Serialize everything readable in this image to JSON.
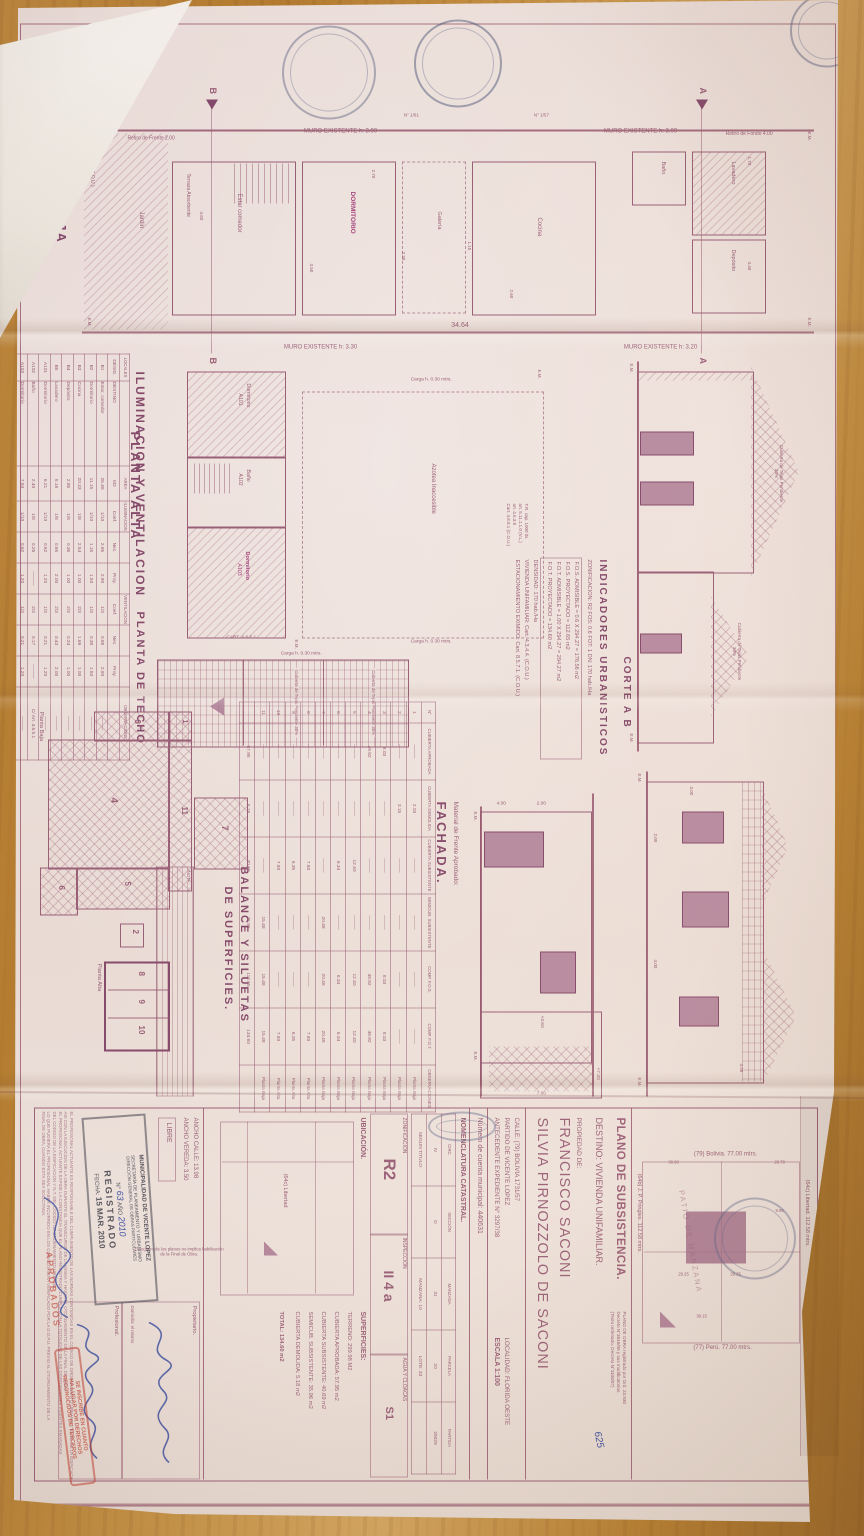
{
  "photo": {
    "background": "wood-table"
  },
  "colors": {
    "ink": "#9a5e77",
    "pink_fill": "#b286a2",
    "highlight": "#a8437e",
    "red_stamp": "#c23b2e",
    "blue_ink": "#3f51a3",
    "paper": "#f0e3de"
  },
  "misc": {
    "em": "E.M."
  },
  "planta_baja": {
    "title": "PLANTA BAJA",
    "calle": "Calle: (79) Bolivia",
    "cart": "CART. 4.7.3.2.2 (C.O.U.)",
    "muro1": "MURO EXISTENTE h: 3.00",
    "muro2": "MURO EXISTENTE h: 3.20",
    "muro3": "MURO EXISTENTE h: 3.00",
    "muro4": "MURO EXISTENTE h: 3.30",
    "retiro_frente": "Retiro de Frente 2.00",
    "retiro_fondo": "Retiro de Fondo 4.00",
    "jardin": "Jardín",
    "terraza": "Terraza Absorbente",
    "galeria": "Galería",
    "rooms": {
      "estar": "Estar comedor",
      "dorm": "DORMITORIO",
      "cocina": "Cocina",
      "deposito": "Depósito",
      "lavadero": "Lavadero",
      "bano": "Baño"
    },
    "dim_total": "34.64",
    "dims": [
      "3.30",
      "3.50",
      "2.70",
      "4.60",
      "1.70",
      "2.60",
      "4.40",
      "1.15"
    ],
    "marker_b": "B",
    "marker_a": "A",
    "nums": [
      "N° 1/57",
      "N° 1/61"
    ]
  },
  "corte": {
    "title": "CORTE A B",
    "cubierta": "Cubierta de Tejas Pendiente 30%"
  },
  "indicadores": {
    "title": "INDICADORES URBANISTICOS",
    "lines": [
      "ZONIFICACION: R2   FOS: 0.6   FOT: 1   DN: 170 hab./Ha",
      "F.O.S. ADMISIBLE = 0.6 X 294.27 = 176.56 m2",
      "F.O.S. PROYECTADO = 112.65 m2",
      "F.O.T. ADMISIBLE = 1.00 X 294.27 = 294.27 m2",
      "F.O.T. PROYECTADO = 134.60 m2",
      "DENSIDAD: 170 hab./Ha",
      "VIVIENDA UNIFAMILIAR: Cart. 4.3.4.4. (C.O.U.)",
      "ESTACIONAMIENTO EXIMIDO: Cart. 8.5.7.1. (C.O.U.)"
    ]
  },
  "planta_alta": {
    "title": "PLANTA ALTA",
    "azotea": "Azotea Inaccesible",
    "carga": "Carga h. 0.30 mtrs.",
    "cart": "CART. 4.6.5.1",
    "tr_note": [
      "T.R. cap. 1000 lts.",
      "art. 5.11.1.1.0 (V.L.)",
      "art. 4.6.3.8",
      "Cart. 4.8.8.1 (C.O.U.)"
    ],
    "rooms": {
      "a101_name": "Dormitorio",
      "a101": "A101",
      "a102_name": "Baño",
      "a102": "A102",
      "a103_name": "Dormitorio",
      "a103": "A103"
    }
  },
  "planta_techo": {
    "title": "PLANTA DE TECHO",
    "cubierta": "Cubierta de Tejas Pendiente 30%",
    "carga": "Carga h. 0.30 mtrs."
  },
  "fachada": {
    "title": "FACHADA.",
    "material": "Material de Frente Aprobado:",
    "dims": [
      "7.60",
      "2.00",
      "4.00",
      "+7.30",
      "+3.60"
    ]
  },
  "elevacion": {
    "dims": [
      "3.98",
      "3.00",
      "2.00",
      "4.00"
    ]
  },
  "iluminacion": {
    "title": "ILUMINACION Y VENTILACION",
    "table": [
      [
        "LOCALES",
        "",
        "AREA",
        "ILUMINACION",
        "",
        "",
        "VENTILACION",
        "",
        "",
        "OBSERVACIONES"
      ],
      [
        "DESIG.",
        "DESTINO",
        "M2",
        "Coef.",
        "Nec.",
        "Proy.",
        "Coef.",
        "Nec.",
        "Proy.",
        ""
      ],
      [
        "B1",
        "Estar, comedor",
        "26.48",
        "1/10",
        "2.65",
        "2.90",
        "1/3",
        "0.88",
        "2.90",
        "———"
      ],
      [
        "B2",
        "Dormitorio",
        "11.15",
        "1/10",
        "1.15",
        "1.50",
        "1/3",
        "0.38",
        "1.50",
        "———"
      ],
      [
        "B3",
        "Cocina",
        "20.33",
        "1/8",
        "2.54",
        "1.00",
        "2/3",
        "1.69",
        "1.00",
        "———"
      ],
      [
        "B4",
        "Depósito",
        "2.85",
        "1/8",
        "0.36",
        "1.00",
        "2/3",
        "0.24",
        "1.00",
        "———"
      ],
      [
        "B5",
        "Lavadero",
        "5.18",
        "1/8",
        "0.65",
        "2.00",
        "2/3",
        "0.43",
        "2.00",
        "———"
      ],
      [
        "A101",
        "Dormitorio",
        "6.21",
        "1/10",
        "0.62",
        "1.20",
        "1/3",
        "0.21",
        "1.20",
        "———"
      ],
      [
        "A102",
        "Baño",
        "2.40",
        "1/8",
        "0.26",
        "———",
        "2/3",
        "0.17",
        "———",
        "C/ Art. 4.6.5.1"
      ],
      [
        "A103",
        "Dormitorio",
        "7.50",
        "1/10",
        "0.62",
        "1.20",
        "1/3",
        "0.21",
        "1.20",
        "———"
      ]
    ]
  },
  "balance": {
    "title_1": "BALANCE Y SILUETAS",
    "title_2": "DE SUPERFICIES.",
    "nota": "NOTA:",
    "planta_baja_label": "Planta Baja",
    "planta_alta_label": "Planta Alta",
    "silhouettes": [
      "1",
      "2",
      "3",
      "4",
      "5",
      "6",
      "7",
      "8",
      "9",
      "10",
      "11"
    ],
    "table": [
      [
        "N°",
        "CUBIERTA APROBADA",
        "CUBIERTA DEMOLIDA",
        "CUBIERTA SUBSISTENTE",
        "SEMICUB. SUBSISTENTE",
        "COMP. F.O.S.",
        "COMP. F.O.T.",
        "OBSERVACIONES"
      ],
      [
        "1",
        "———",
        "2.03",
        "———",
        "———",
        "———",
        "———",
        "Planta Baja"
      ],
      [
        "2",
        "———",
        "3.15",
        "———",
        "———",
        "———",
        "———",
        "Planta Baja"
      ],
      [
        "3",
        "8.03",
        "———",
        "———",
        "———",
        "8.03",
        "8.03",
        "Planta Baja"
      ],
      [
        "4",
        "49.92",
        "———",
        "———",
        "———",
        "49.92",
        "49.92",
        "Planta Baja"
      ],
      [
        "5",
        "———",
        "———",
        "12.40",
        "———",
        "12.40",
        "12.40",
        "Planta Baja"
      ],
      [
        "6",
        "———",
        "———",
        "6.34",
        "———",
        "6.34",
        "6.34",
        "Planta Baja"
      ],
      [
        "7",
        "———",
        "———",
        "———",
        "20.48",
        "20.48",
        "20.48",
        "Planta Baja"
      ],
      [
        "8",
        "———",
        "———",
        "7.80",
        "———",
        "———",
        "7.80",
        "Planta Alta"
      ],
      [
        "9",
        "———",
        "———",
        "6.35",
        "———",
        "———",
        "6.35",
        "Planta Alta"
      ],
      [
        "10",
        "———",
        "———",
        "7.80",
        "———",
        "———",
        "7.80",
        "Planta Alta"
      ],
      [
        "11",
        "———",
        "———",
        "———",
        "15.48",
        "15.48",
        "15.48",
        "Planta Baja"
      ],
      [
        "",
        "57.95",
        "5.18",
        "40.69",
        "35.96",
        "112.65",
        "134.60",
        ""
      ]
    ]
  },
  "title_block": {
    "patio": {
      "bolivia": "(79) Bolivia. 77.00 mtrs.",
      "peru": "(77) Perú. 77.00 mtrs.",
      "libertad": "(64c) Libertad. 112.58 mtrs.",
      "pringles": "(64b) J. P. Pringles. 112.58 mtrs.",
      "name": "PATIO DE MANZANA",
      "dims": [
        "28.78",
        "9.98",
        "38.98",
        "29.25",
        "29.25",
        "38.15"
      ]
    },
    "plano_obra": [
      "PLANO DE OBRA registrado por Ord. 23.930",
      "Decreto N°3616/06 y sus modificatorios.",
      "(Texto ordenado. Decreto N°1106/07)"
    ],
    "nota_manuscrita": "625",
    "titulo": "PLANO DE SUBSISTENCIA.",
    "destino": "DESTINO: VIVIENDA UNIFAMILIAR.",
    "propiedad": "PROPIEDAD DE:",
    "owner_1": "FRANCISCO SACONI",
    "owner_2": "SILVIA PIRNOZZOLO DE SACONI",
    "calle": "CALLE: (79) BOLIVIA 1731/57",
    "partido": "PARTIDO DE VICENTE LOPEZ",
    "antecedente": "ANTECEDENTE EXPEDIENTE N° 3297/38",
    "localidad": "LOCALIDAD: FLORIDA OESTE",
    "escala": "ESCALA 1:100",
    "cuenta": "Número de cuenta municipal: 440631",
    "nomenclatura": {
      "titulo": "NOMENCLATURA CATASTRAL.",
      "table": [
        [
          "CIRC.",
          "SECCIÓN",
          "MANZANA",
          "PARCELA",
          "PARTIDA"
        ],
        [
          "IV",
          "D",
          "31",
          "20",
          "29029"
        ],
        [
          "SEGUN TITULO:",
          "",
          "MANZANA: 10",
          "LOTE: 33",
          ""
        ]
      ]
    },
    "zonificacion_label": "ZONIFICACIÓN",
    "zonificacion": "R2",
    "inspeccion_label": "INSPECCIÓN",
    "inspeccion": "II 4 a",
    "agua_label": "AGUA Y CLOACAS",
    "agua": "S1",
    "ubicacion_label": "UBICACIÓN.",
    "ubicacion_calle": "(64c) Libertad",
    "superficies_label": "SUPERFICIES:",
    "superficies": [
      "TERRENO: 299.98 M2",
      "CUBIERTA APROBADA: 57.95 m2",
      "CUBIERTA SUBSISTENTE: 40.69 m2",
      "SEMICUB. SUBSISTENTE: 35.96 m2",
      "CUBIERTA DEMOLIDA: 5.18 m2",
      "TOTAL: 134.60 m2"
    ],
    "ancho_calle": "ANCHO CALLE: 13.98",
    "ancho_vereda": "ANCHO VEREDA: 3.50",
    "libre": "LIBRE",
    "registro_nota": "El registro de los planos no implica habilitación de la Final de Obra.",
    "propietario_label": "Propietario.",
    "domicilio": "Domicilio: el mismo",
    "profesional_label": "Profesional.",
    "stamp": {
      "l1": "MUNICIPALIDAD DE VICENTE LOPEZ",
      "l2": "SECRETARÍA DE PLANEAMIENTO Y URBANISMO",
      "l3": "DIRECCIÓN GENERAL DE OBRAS PARTICULARES",
      "num_label": "N°",
      "num": "63",
      "ano_label": "AÑO",
      "ano": "2010",
      "registrado": "REGISTRADO",
      "fecha_label": "FECHA:",
      "fecha": "15 MAR. 2010"
    },
    "red_stamp": [
      "SE INSCRIBE EN CUANTO",
      "HA LUGAR POR DERECHOS",
      "RECONOCIDOS DE TERCEROS"
    ],
    "red_word": "APROBADOS",
    "fine_print": [
      "EL PROFESIONAL ACTUANTE ES RESPONSABLE DEL CUMPLIMIENTO DE LAS NORMAS CONTENIDAS EN EL CODIGO DE ORDENAMIENTO URBANO Y EN EL DE LA EDIFICACION",
      "ASI CON LA EJECUCION DE LA OBRA DURANTE EL TRANSCURSO DE LA MISMA Y HASTA EL OTORGAMIENTO DE LA FINAL DE OBRA.",
      "EL PROFESIONAL ACTUANTE EXPIDE LA CONSTANCIA QUE EL PLANO REGISTRADO CUMPLE CON LA TOTALIDAD DE LAS DISPOSICIONES VIGENTES EMANADAS",
      "DEL CODIGO DE LA EDIFICACION Y N.T. DEL CODIGO DE ORDENAMIENTO URBANO.",
      "LO QUE PUDIERA EL PROFESIONAL HABER INCURRIDO EN LOS COMISOS SERA VERIFICADO POR LA D.O.P.U. PREVIO AL OTORGAMIENTO DE LA",
      "FINAL DE OBRA, CUANDO ESTA SEA SOLICITADA."
    ]
  }
}
